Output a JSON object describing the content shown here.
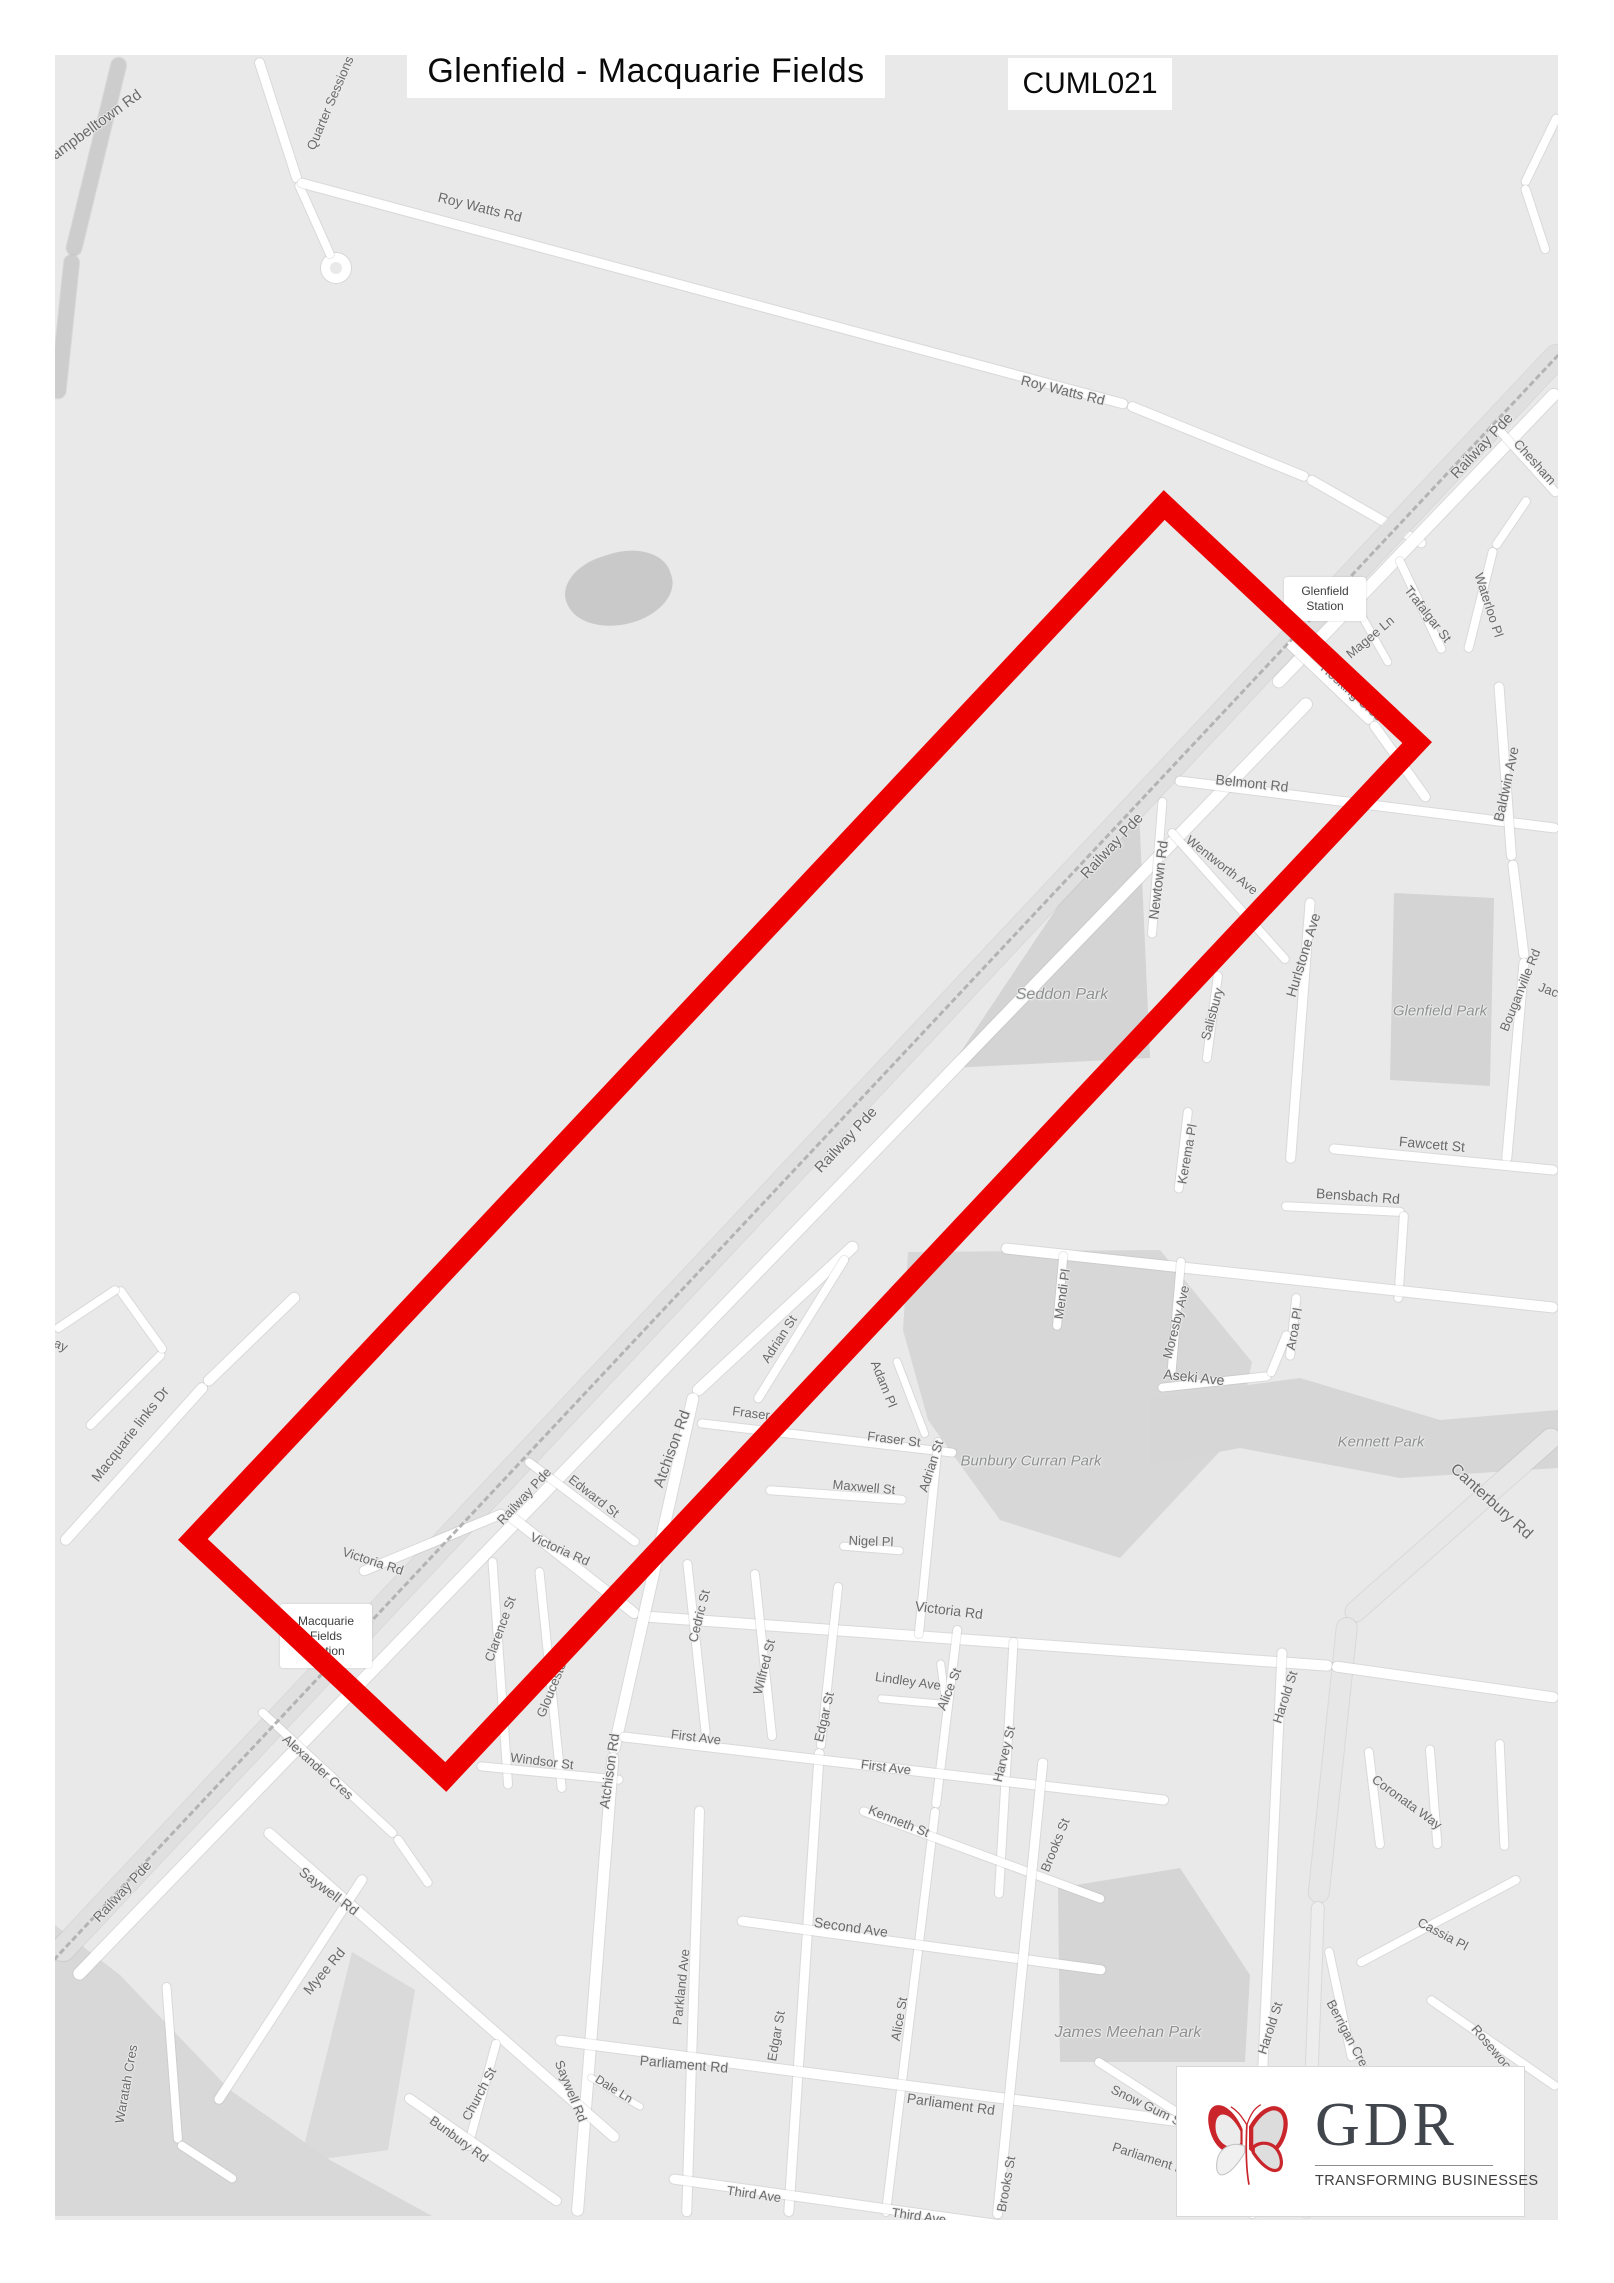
{
  "header": {
    "title": "Glenfield - Macquarie Fields",
    "code": "CUML021"
  },
  "logo": {
    "name": "GDR",
    "tagline": "TRANSFORMING BUSINESSES",
    "accent": "#c9252b",
    "text_color": "#41454c"
  },
  "map": {
    "background": "#e9e9e9",
    "highlight_color": "#ed0000",
    "highlight": {
      "cx": 805,
      "cy": 1141,
      "w": 1440,
      "h": 368,
      "angle": -46.8,
      "stroke": 21
    },
    "stations": [
      {
        "lines": [
          "Glenfield",
          "Station"
        ],
        "x": 1284,
        "y": 577,
        "w": 82,
        "h": 44
      },
      {
        "lines": [
          "Macquarie",
          "Fields",
          "Station"
        ],
        "x": 280,
        "y": 1604,
        "w": 92,
        "h": 64
      }
    ],
    "street_labels": [
      {
        "t": "Campbelltown Rd",
        "x": 92,
        "y": 128,
        "r": -36,
        "s": 15
      },
      {
        "t": "Quarter Sessions",
        "x": 330,
        "y": 103,
        "r": -67,
        "s": 13
      },
      {
        "t": "Roy Watts Rd",
        "x": 480,
        "y": 207,
        "r": 14,
        "s": 14
      },
      {
        "t": "Roy Watts Rd",
        "x": 1063,
        "y": 390,
        "r": 14,
        "s": 14
      },
      {
        "t": "Railway Pde",
        "x": 1482,
        "y": 446,
        "r": -47,
        "s": 15
      },
      {
        "t": "Chesham",
        "x": 1535,
        "y": 462,
        "r": 48,
        "s": 13
      },
      {
        "t": "Magee Ln",
        "x": 1370,
        "y": 637,
        "r": -40,
        "s": 13
      },
      {
        "t": "Trafalgar St",
        "x": 1428,
        "y": 614,
        "r": 52,
        "s": 13
      },
      {
        "t": "Waterloo Pl",
        "x": 1489,
        "y": 605,
        "r": 72,
        "s": 13
      },
      {
        "t": "Hosking Cres",
        "x": 1352,
        "y": 692,
        "r": 42,
        "s": 13
      },
      {
        "t": "Belmont Rd",
        "x": 1252,
        "y": 783,
        "r": 6,
        "s": 14
      },
      {
        "t": "Baldwin Ave",
        "x": 1506,
        "y": 784,
        "r": -78,
        "s": 14
      },
      {
        "t": "Newtown Rd",
        "x": 1158,
        "y": 880,
        "r": -83,
        "s": 14
      },
      {
        "t": "Wentworth Ave",
        "x": 1222,
        "y": 865,
        "r": 38,
        "s": 13
      },
      {
        "t": "Railway Pde",
        "x": 1112,
        "y": 846,
        "r": -47,
        "s": 15
      },
      {
        "t": "Hurlstone Ave",
        "x": 1303,
        "y": 955,
        "r": -73,
        "s": 14
      },
      {
        "t": "Salisbury",
        "x": 1212,
        "y": 1014,
        "r": -75,
        "s": 13
      },
      {
        "t": "Bouganville Rd",
        "x": 1520,
        "y": 990,
        "r": -68,
        "s": 13
      },
      {
        "t": "Jacq",
        "x": 1552,
        "y": 991,
        "r": 20,
        "s": 13
      },
      {
        "t": "Fawcett St",
        "x": 1432,
        "y": 1144,
        "r": 5,
        "s": 14
      },
      {
        "t": "Bensbach Rd",
        "x": 1358,
        "y": 1196,
        "r": 4,
        "s": 14
      },
      {
        "t": "Kerema Pl",
        "x": 1187,
        "y": 1154,
        "r": -80,
        "s": 13
      },
      {
        "t": "Mendi Pl",
        "x": 1062,
        "y": 1294,
        "r": -82,
        "s": 13
      },
      {
        "t": "Moresby Ave",
        "x": 1176,
        "y": 1322,
        "r": -76,
        "s": 13
      },
      {
        "t": "Aroa Pl",
        "x": 1294,
        "y": 1329,
        "r": -80,
        "s": 13
      },
      {
        "t": "Aseki Ave",
        "x": 1194,
        "y": 1377,
        "r": 6,
        "s": 14
      },
      {
        "t": "Canterbury Rd",
        "x": 1491,
        "y": 1502,
        "r": 42,
        "s": 16
      },
      {
        "t": "Railway Pde",
        "x": 846,
        "y": 1140,
        "r": -47,
        "s": 15
      },
      {
        "t": "Adrian St",
        "x": 779,
        "y": 1339,
        "r": -57,
        "s": 13
      },
      {
        "t": "Adam Pl",
        "x": 884,
        "y": 1384,
        "r": 68,
        "s": 13
      },
      {
        "t": "Fraser St",
        "x": 759,
        "y": 1414,
        "r": 7,
        "s": 13
      },
      {
        "t": "Fraser St",
        "x": 894,
        "y": 1439,
        "r": 7,
        "s": 13
      },
      {
        "t": "Adrian St",
        "x": 931,
        "y": 1466,
        "r": -72,
        "s": 13
      },
      {
        "t": "Atchison Rd",
        "x": 672,
        "y": 1449,
        "r": -70,
        "s": 15
      },
      {
        "t": "Maxwell St",
        "x": 864,
        "y": 1487,
        "r": 5,
        "s": 13
      },
      {
        "t": "Nigel Pl",
        "x": 871,
        "y": 1541,
        "r": 2,
        "s": 13
      },
      {
        "t": "Victoria Rd",
        "x": 560,
        "y": 1549,
        "r": 24,
        "s": 13
      },
      {
        "t": "Victoria Rd",
        "x": 373,
        "y": 1561,
        "r": 18,
        "s": 13
      },
      {
        "t": "Victoria Rd",
        "x": 949,
        "y": 1610,
        "r": 7,
        "s": 14
      },
      {
        "t": "Clarence St",
        "x": 500,
        "y": 1629,
        "r": -70,
        "s": 13
      },
      {
        "t": "Gloucester St",
        "x": 555,
        "y": 1680,
        "r": -68,
        "s": 13
      },
      {
        "t": "Windsor St",
        "x": 542,
        "y": 1761,
        "r": 7,
        "s": 13
      },
      {
        "t": "Alexander Cres",
        "x": 318,
        "y": 1767,
        "r": 42,
        "s": 13
      },
      {
        "t": "Railway Pde",
        "x": 524,
        "y": 1496,
        "r": -47,
        "s": 13
      },
      {
        "t": "Railway Pde",
        "x": 122,
        "y": 1891,
        "r": -47,
        "s": 14
      },
      {
        "t": "Edward St",
        "x": 594,
        "y": 1496,
        "r": 38,
        "s": 13
      },
      {
        "t": "Atchison Rd",
        "x": 609,
        "y": 1771,
        "r": -82,
        "s": 14
      },
      {
        "t": "Cedric St",
        "x": 699,
        "y": 1616,
        "r": -76,
        "s": 13
      },
      {
        "t": "Wilfred St",
        "x": 764,
        "y": 1667,
        "r": -76,
        "s": 13
      },
      {
        "t": "Edgar St",
        "x": 824,
        "y": 1717,
        "r": -77,
        "s": 13
      },
      {
        "t": "Lindley Ave",
        "x": 908,
        "y": 1681,
        "r": 8,
        "s": 13
      },
      {
        "t": "Alice St",
        "x": 949,
        "y": 1689,
        "r": -68,
        "s": 13
      },
      {
        "t": "Harvey St",
        "x": 1004,
        "y": 1754,
        "r": -76,
        "s": 13
      },
      {
        "t": "First Ave",
        "x": 696,
        "y": 1737,
        "r": 7,
        "s": 13
      },
      {
        "t": "First Ave",
        "x": 886,
        "y": 1767,
        "r": 7,
        "s": 13
      },
      {
        "t": "Kenneth St",
        "x": 899,
        "y": 1821,
        "r": 22,
        "s": 13
      },
      {
        "t": "Second Ave",
        "x": 851,
        "y": 1927,
        "r": 8,
        "s": 14
      },
      {
        "t": "Parkland Ave",
        "x": 681,
        "y": 1987,
        "r": -84,
        "s": 13
      },
      {
        "t": "Saywell Rd",
        "x": 329,
        "y": 1891,
        "r": 37,
        "s": 14
      },
      {
        "t": "Myee Rd",
        "x": 324,
        "y": 1971,
        "r": -50,
        "s": 14
      },
      {
        "t": "Waratah Cres",
        "x": 126,
        "y": 2084,
        "r": -80,
        "s": 13
      },
      {
        "t": "Church St",
        "x": 479,
        "y": 2094,
        "r": -62,
        "s": 13
      },
      {
        "t": "Bunbury Rd",
        "x": 459,
        "y": 2139,
        "r": 36,
        "s": 13
      },
      {
        "t": "Saywell Rd",
        "x": 571,
        "y": 2091,
        "r": 68,
        "s": 13
      },
      {
        "t": "Dale Ln",
        "x": 614,
        "y": 2089,
        "r": 32,
        "s": 12
      },
      {
        "t": "Parliament Rd",
        "x": 684,
        "y": 2064,
        "r": 5,
        "s": 14
      },
      {
        "t": "Parliament Rd",
        "x": 951,
        "y": 2104,
        "r": 8,
        "s": 14
      },
      {
        "t": "Edgar St",
        "x": 776,
        "y": 2036,
        "r": -80,
        "s": 13
      },
      {
        "t": "Alice St",
        "x": 899,
        "y": 2019,
        "r": -80,
        "s": 13
      },
      {
        "t": "Brooks St",
        "x": 1055,
        "y": 1845,
        "r": -68,
        "s": 13
      },
      {
        "t": "Brooks St",
        "x": 1006,
        "y": 2184,
        "r": -80,
        "s": 13
      },
      {
        "t": "Third Ave",
        "x": 754,
        "y": 2194,
        "r": 8,
        "s": 13
      },
      {
        "t": "Third Ave",
        "x": 919,
        "y": 2216,
        "r": 8,
        "s": 13
      },
      {
        "t": "Snow Gum St",
        "x": 1148,
        "y": 2106,
        "r": 26,
        "s": 13
      },
      {
        "t": "Parliament Rd",
        "x": 1152,
        "y": 2159,
        "r": 18,
        "s": 13
      },
      {
        "t": "Harold St",
        "x": 1285,
        "y": 1697,
        "r": -72,
        "s": 13
      },
      {
        "t": "Harold St",
        "x": 1270,
        "y": 2028,
        "r": -72,
        "s": 13
      },
      {
        "t": "Coronata Way",
        "x": 1407,
        "y": 1802,
        "r": 36,
        "s": 13
      },
      {
        "t": "Cassia Pl",
        "x": 1443,
        "y": 1934,
        "r": 28,
        "s": 13
      },
      {
        "t": "Berrigan Cres",
        "x": 1349,
        "y": 2036,
        "r": 62,
        "s": 13
      },
      {
        "t": "Rosewood",
        "x": 1494,
        "y": 2050,
        "r": 50,
        "s": 13
      },
      {
        "t": "Macquarie links Dr",
        "x": 130,
        "y": 1434,
        "r": -52,
        "s": 14
      },
      {
        "t": "ay",
        "x": 61,
        "y": 1345,
        "r": 25,
        "s": 13
      },
      {
        "t": "Seddon Park",
        "x": 1062,
        "y": 995,
        "r": 0,
        "s": 16,
        "park": true
      },
      {
        "t": "Glenfield Park",
        "x": 1440,
        "y": 1011,
        "r": 0,
        "s": 15,
        "park": true
      },
      {
        "t": "Kennett Park",
        "x": 1381,
        "y": 1442,
        "r": 0,
        "s": 15,
        "park": true
      },
      {
        "t": "Bunbury Curran Park",
        "x": 1031,
        "y": 1461,
        "r": 0,
        "s": 15,
        "park": true
      },
      {
        "t": "James Meehan Park",
        "x": 1128,
        "y": 2033,
        "r": 0,
        "s": 16,
        "park": true
      }
    ],
    "parks": [
      {
        "points": "1138px 786px,1150px 1058px,950px 1068px",
        "color": "#d4d4d4"
      },
      {
        "points": "1394px 893px,1494px 898px,1490px 1086px,1390px 1080px",
        "color": "#d4d4d4"
      },
      {
        "points": "1150px 1398px,1300px 1378px,1440px 1420px,1558px 1410px,1558px 1468px,1400px 1478px,1240px 1448px,1150px 1465px",
        "color": "#d6d6d6"
      },
      {
        "points": "908px 1252px,1160px 1250px,1252px 1362px,1238px 1432px,1120px 1558px,1000px 1520px,928px 1420px,903px 1330px",
        "color": "#d7d7d7"
      },
      {
        "points": "1058px 1888px,1180px 1868px,1250px 1975px,1245px 2062px,1060px 2062px",
        "color": "#d5d5d5"
      },
      {
        "points": "55px 1925px,120px 1975px,230px 2090px,330px 2160px,432px 2216px,55px 2216px",
        "color": "#d8d8d8"
      },
      {
        "points": "352px 1952px,415px 1990px,388px 2150px,300px 2162px",
        "color": "#dadada"
      }
    ],
    "roads": [
      [
        120,
        58,
        72,
        255,
        15,
        "#cdcdcd"
      ],
      [
        72,
        255,
        57,
        398,
        15,
        "#cdcdcd"
      ],
      [
        258,
        58,
        298,
        182,
        9
      ],
      [
        298,
        182,
        332,
        258,
        8
      ],
      [
        298,
        182,
        1128,
        405,
        9
      ],
      [
        1128,
        405,
        1308,
        478,
        9
      ],
      [
        1308,
        478,
        1425,
        545,
        9
      ],
      [
        1565,
        348,
        55,
        1958,
        24,
        "#e0e0e0"
      ],
      [
        1558,
        390,
        1275,
        685,
        12
      ],
      [
        1310,
        700,
        75,
        1978,
        12
      ],
      [
        1288,
        642,
        1372,
        722,
        9
      ],
      [
        1372,
        722,
        1428,
        800,
        9
      ],
      [
        1175,
        780,
        1558,
        828,
        9
      ],
      [
        1499,
        682,
        1512,
        860,
        9
      ],
      [
        1512,
        860,
        1524,
        958,
        9
      ],
      [
        1524,
        958,
        1506,
        1162,
        9
      ],
      [
        1352,
        598,
        1390,
        665,
        7
      ],
      [
        1398,
        557,
        1443,
        652,
        8
      ],
      [
        1528,
        498,
        1494,
        548,
        8
      ],
      [
        1494,
        548,
        1468,
        652,
        8
      ],
      [
        1492,
        422,
        1558,
        495,
        8
      ],
      [
        1558,
        115,
        1524,
        185,
        8
      ],
      [
        1524,
        185,
        1546,
        252,
        8
      ],
      [
        1163,
        798,
        1152,
        938,
        8
      ],
      [
        1170,
        830,
        1288,
        962,
        8
      ],
      [
        1310,
        898,
        1290,
        1162,
        9
      ],
      [
        1218,
        972,
        1206,
        1062,
        8
      ],
      [
        1330,
        1148,
        1558,
        1170,
        9
      ],
      [
        1282,
        1206,
        1404,
        1212,
        8
      ],
      [
        1404,
        1212,
        1398,
        1302,
        8
      ],
      [
        1188,
        1108,
        1178,
        1192,
        8
      ],
      [
        1002,
        1248,
        1558,
        1308,
        10
      ],
      [
        1064,
        1252,
        1057,
        1330,
        8
      ],
      [
        1181,
        1258,
        1171,
        1376,
        8
      ],
      [
        1297,
        1294,
        1290,
        1360,
        8
      ],
      [
        1158,
        1388,
        1270,
        1376,
        8
      ],
      [
        1270,
        1376,
        1288,
        1332,
        8
      ],
      [
        1558,
        1432,
        1348,
        1618,
        20,
        "#e7e7e7"
      ],
      [
        1348,
        1618,
        1318,
        1902,
        20,
        "#e7e7e7"
      ],
      [
        1318,
        1902,
        1306,
        2218,
        12,
        "#ededed"
      ],
      [
        638,
        1616,
        1332,
        1666,
        10
      ],
      [
        1332,
        1666,
        1558,
        1698,
        10
      ],
      [
        505,
        1512,
        638,
        1616,
        10
      ],
      [
        360,
        1572,
        505,
        1512,
        9
      ],
      [
        1282,
        1648,
        1262,
        2080,
        9
      ],
      [
        1262,
        2080,
        1252,
        2218,
        9
      ],
      [
        492,
        1558,
        508,
        1788,
        8
      ],
      [
        539,
        1568,
        562,
        1792,
        8
      ],
      [
        477,
        1766,
        622,
        1780,
        8
      ],
      [
        856,
        1243,
        694,
        1393,
        11
      ],
      [
        694,
        1393,
        613,
        1753,
        11
      ],
      [
        613,
        1753,
        577,
        2216,
        11
      ],
      [
        846,
        1256,
        756,
        1401,
        8
      ],
      [
        896,
        1358,
        926,
        1436,
        7
      ],
      [
        698,
        1423,
        956,
        1453,
        8
      ],
      [
        938,
        1438,
        918,
        1638,
        8
      ],
      [
        766,
        1490,
        906,
        1500,
        8
      ],
      [
        840,
        1546,
        903,
        1551,
        7
      ],
      [
        687,
        1560,
        706,
        1736,
        8
      ],
      [
        754,
        1570,
        772,
        1740,
        8
      ],
      [
        838,
        1583,
        820,
        1749,
        8
      ],
      [
        820,
        1749,
        789,
        2216,
        9
      ],
      [
        878,
        1698,
        946,
        1704,
        7
      ],
      [
        940,
        1660,
        946,
        1704,
        7
      ],
      [
        958,
        1626,
        936,
        1808,
        8
      ],
      [
        936,
        1808,
        886,
        2216,
        8
      ],
      [
        1014,
        1638,
        999,
        1898,
        8
      ],
      [
        620,
        1736,
        1168,
        1800,
        9
      ],
      [
        860,
        1810,
        1104,
        1900,
        8
      ],
      [
        738,
        1920,
        1106,
        1970,
        9
      ],
      [
        700,
        1806,
        687,
        2216,
        9
      ],
      [
        556,
        2040,
        1446,
        2156,
        10
      ],
      [
        670,
        2178,
        1012,
        2226,
        9
      ],
      [
        1043,
        1758,
        997,
        2218,
        9
      ],
      [
        266,
        1830,
        618,
        2140,
        10
      ],
      [
        216,
        2103,
        364,
        1876,
        9
      ],
      [
        166,
        1983,
        178,
        2143,
        8
      ],
      [
        178,
        2143,
        235,
        2180,
        8
      ],
      [
        260,
        1710,
        396,
        1836,
        8
      ],
      [
        396,
        1836,
        430,
        1885,
        8
      ],
      [
        497,
        2040,
        467,
        2150,
        8
      ],
      [
        406,
        2096,
        560,
        2203,
        9
      ],
      [
        588,
        2076,
        642,
        2108,
        6
      ],
      [
        1096,
        2060,
        1186,
        2118,
        8
      ],
      [
        62,
        1543,
        205,
        1384,
        10
      ],
      [
        205,
        1384,
        298,
        1294,
        10
      ],
      [
        88,
        1428,
        164,
        1352,
        8
      ],
      [
        164,
        1352,
        118,
        1288,
        8
      ],
      [
        118,
        1288,
        55,
        1330,
        8
      ],
      [
        526,
        1460,
        638,
        1544,
        8
      ],
      [
        1358,
        1964,
        1520,
        1878,
        8
      ],
      [
        1428,
        1998,
        1558,
        2088,
        8
      ],
      [
        1328,
        1948,
        1352,
        2060,
        8
      ],
      [
        1368,
        1748,
        1380,
        1848,
        8
      ],
      [
        1430,
        1745,
        1438,
        1848,
        8
      ],
      [
        1500,
        1740,
        1505,
        1850,
        8
      ]
    ]
  }
}
